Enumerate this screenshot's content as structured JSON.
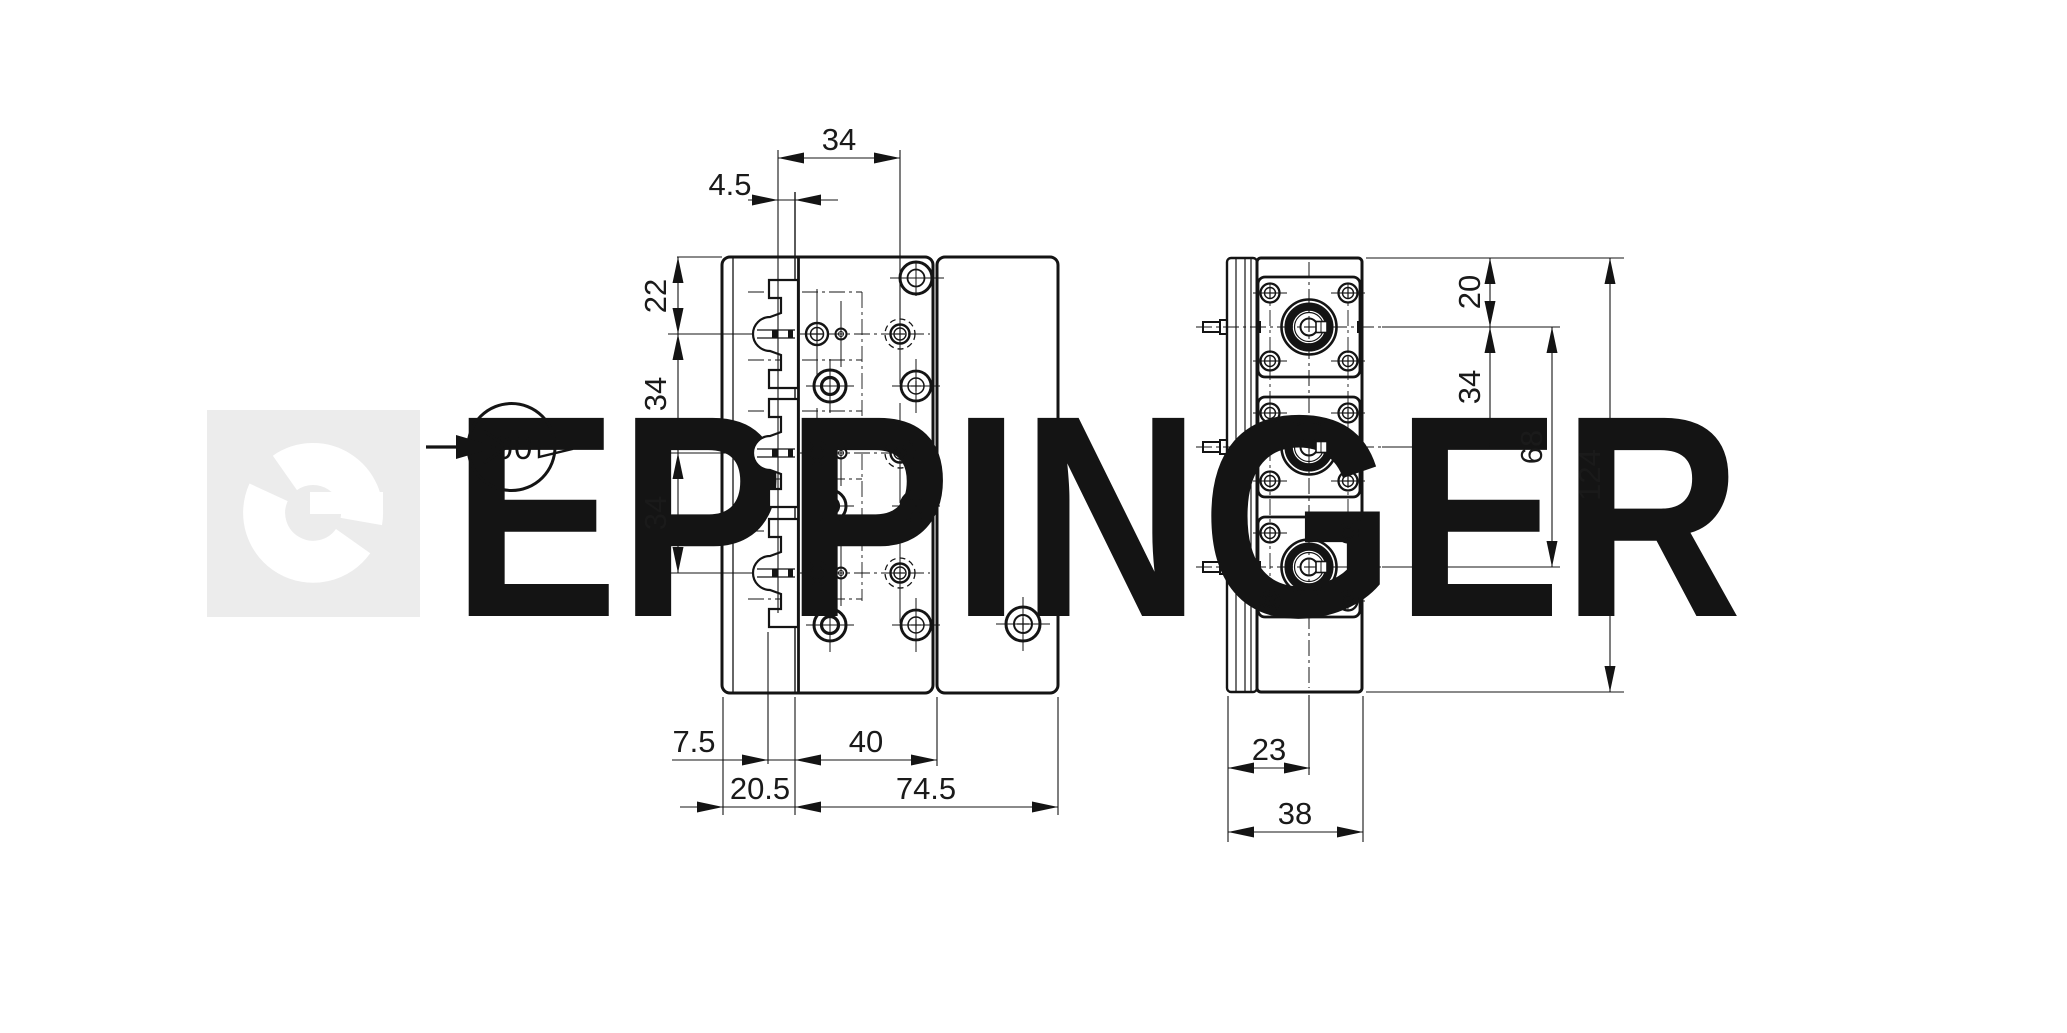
{
  "watermark": {
    "text": "EPPINGER",
    "color": "#ececec"
  },
  "view_direction_symbol": {
    "label": "00"
  },
  "front_view": {
    "dimensions": {
      "row_pitch_top": "34",
      "clamp_plane_offset": "4.5",
      "top_to_first_row": "22",
      "row_pitch_left_1": "34",
      "row_pitch_left_2": "34",
      "clamp_depth": "7.5",
      "hole_span": "40",
      "plate_width": "20.5",
      "body_width": "74.5"
    }
  },
  "side_view": {
    "dimensions": {
      "top_to_first_port": "20",
      "port_pitch": "34",
      "port_span": "68",
      "total_height": "124",
      "face_to_axis": "23",
      "total_depth": "38"
    }
  },
  "colors": {
    "line": "#141414",
    "watermark": "#ececec",
    "background": "#ffffff"
  }
}
